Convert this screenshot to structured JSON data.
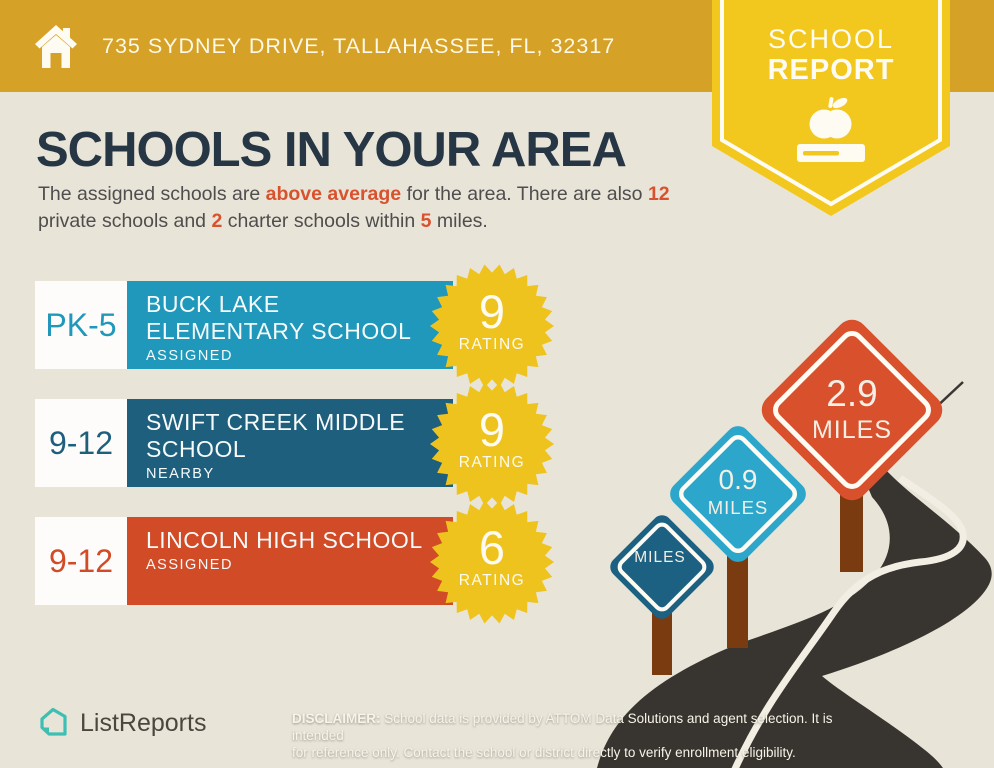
{
  "header": {
    "address": "735 SYDNEY DRIVE, TALLAHASSEE, FL, 32317"
  },
  "ribbon": {
    "line1": "SCHOOL",
    "line2": "REPORT"
  },
  "main": {
    "title": "SCHOOLS IN YOUR AREA",
    "intro": {
      "seg1": "The assigned schools are ",
      "hl1": "above average",
      "seg2": " for the area. There are also ",
      "hl2": "12",
      "seg3": " private schools and ",
      "hl3": "2",
      "seg4": " charter schools within ",
      "hl4": "5",
      "seg5": " miles."
    }
  },
  "schools": [
    {
      "grades": "PK-5",
      "name_line1": "BUCK LAKE",
      "name_line2": "ELEMENTARY SCHOOL",
      "status": "ASSIGNED",
      "rating": "9",
      "rating_label": "RATING"
    },
    {
      "grades": "9-12",
      "name_line1": "SWIFT CREEK MIDDLE",
      "name_line2": "SCHOOL",
      "status": "NEARBY",
      "rating": "9",
      "rating_label": "RATING"
    },
    {
      "grades": "9-12",
      "name_line1": "LINCOLN HIGH SCHOOL",
      "name_line2": "",
      "status": "ASSIGNED",
      "rating": "6",
      "rating_label": "RATING"
    }
  ],
  "signs": [
    {
      "value": "",
      "unit": "MILES"
    },
    {
      "value": "0.9",
      "unit": "MILES"
    },
    {
      "value": "2.9",
      "unit": "MILES"
    }
  ],
  "footer": {
    "logo_text": "ListReports",
    "disclaimer_label": "DISCLAIMER:",
    "disclaimer_line1": " School data is provided by ATTOM Data Solutions and agent selection. It is intended",
    "disclaimer_line2": "for reference only. Contact the school or district directly to verify enrollment eligibility."
  },
  "colors": {
    "header_gold": "#D5A126",
    "ribbon_yellow": "#F2C71E",
    "background_beige": "#E9E4D8",
    "heading_navy": "#263645",
    "accent_orange": "#D9522E",
    "row_teal": "#2098BB",
    "row_blue": "#1E5F7E",
    "row_orange": "#D14B27",
    "rating_yellow": "#EFC31D",
    "road_dark": "#38342F",
    "post_brown": "#7A3B11",
    "sign_small_blue": "#1D6182",
    "sign_medium_teal": "#2CA6CA",
    "sign_large_red": "#D9502C",
    "logo_teal": "#3EBFB3"
  }
}
